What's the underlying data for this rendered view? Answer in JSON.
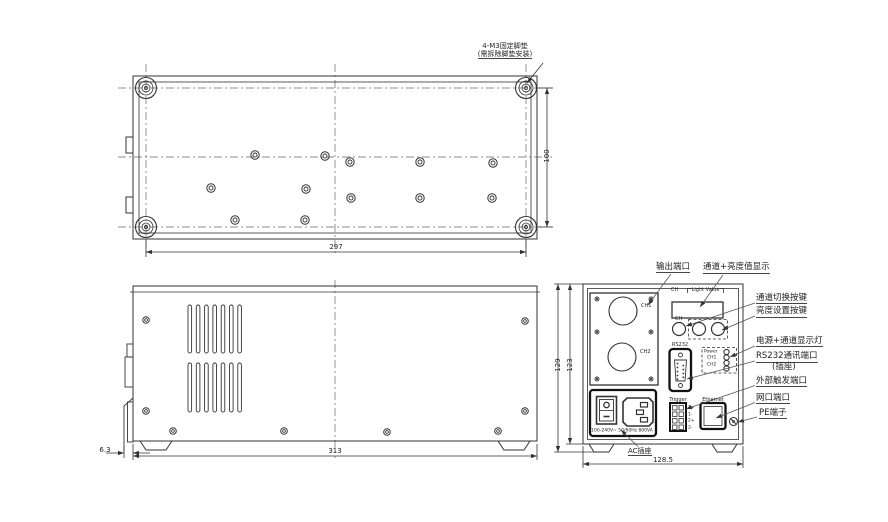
{
  "bottom_view": {
    "foot_note_line1": "4-M3固定脚垫",
    "foot_note_line2": "(需拆除脚垫安装)",
    "dim_width": "297",
    "dim_depth": "100"
  },
  "side_view": {
    "dim_length": "313",
    "dim_offset": "6.3"
  },
  "rear_view": {
    "dim_height_outer": "129",
    "dim_height_inner": "123",
    "dim_width": "128.5",
    "panel": {
      "ch_header": "CH",
      "light_value_header": "Light Value",
      "ch1_label": "CH1",
      "ch2_label": "CH2",
      "knob_ch_label": "CH",
      "rs232_label": "RS232",
      "led_power": "Power",
      "led_ch1": "CH1",
      "led_ch2": "CH2",
      "trigger_label": "Trigger",
      "trigger_t1": "1+",
      "trigger_t2": "1-",
      "trigger_t3": "2+",
      "trigger_t4": "2-",
      "ethernet_label": "Ethernet",
      "rating_text": "100-240V~ 50/60Hz 800VA",
      "ac_socket_note": "AC插座"
    }
  },
  "callouts": {
    "output_port": "输出端口",
    "display": "通道+亮度值显示",
    "channel_switch": "通道切换按键",
    "brightness_set": "亮度设置按键",
    "power_leds": "电源+通道显示灯",
    "rs232_line1": "RS232通讯端口",
    "rs232_line2": "(插座)",
    "trigger": "外部触发端口",
    "ethernet": "网口端口",
    "pe": "PE端子"
  },
  "colors": {
    "line": "#333333",
    "thick": "#111111"
  }
}
